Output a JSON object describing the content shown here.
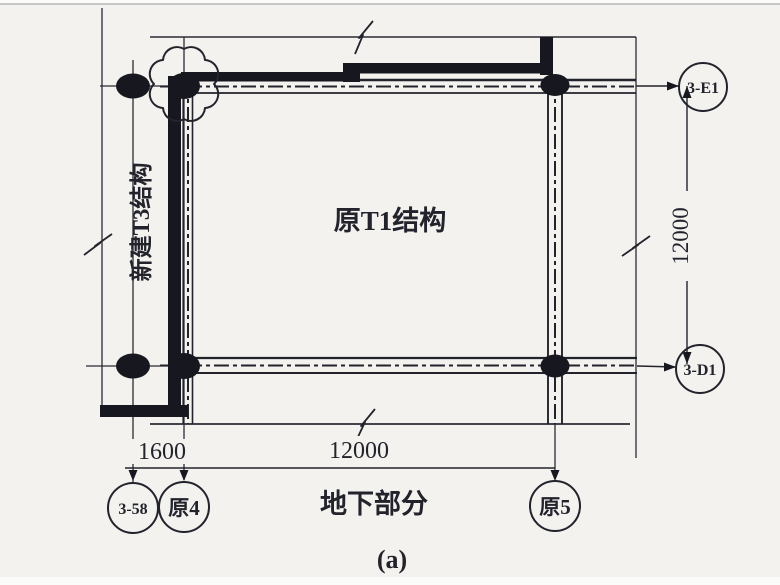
{
  "colors": {
    "paper": "#f3f2ef",
    "ink": "#23232c"
  },
  "labels": {
    "original_structure": "原T1结构",
    "new_structure": "新建T3结构",
    "underground": "地下部分",
    "caption": "(a)"
  },
  "dimensions": {
    "left_offset": "1600",
    "bottom_span": "12000",
    "right_span": "12000"
  },
  "grid_bubbles": {
    "aux_left": "3-58",
    "old_col_4": "原4",
    "old_col_5": "原5",
    "top_right": "3-E1",
    "bottom_right": "3-D1"
  }
}
